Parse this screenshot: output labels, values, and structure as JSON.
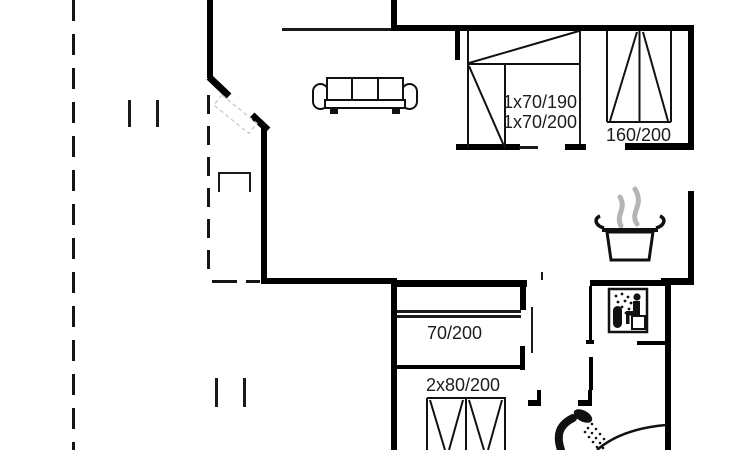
{
  "drawing": {
    "type": "floor-plan",
    "background_color": "#ffffff",
    "wall_color": "#000000",
    "text_color": "#1c1c1c",
    "steam_color": "#b5b5b5",
    "door_leaf_color": "#c9c9c9"
  },
  "rooms": {
    "bedroom_bunk": {
      "bed_label_line1": "1x70/190",
      "bed_label_line2": "1x70/200"
    },
    "bedroom_double": {
      "bed_label": "160/200"
    },
    "bedroom_single": {
      "bed_label": "70/200"
    },
    "bedroom_double2": {
      "bed_label": "2x80/200"
    }
  },
  "icons": {
    "sofa": "sofa-icon",
    "cooking_pot": "cooking-pot-icon",
    "steam": "steam-icon",
    "sauna": "sauna-icon",
    "shower": "shower-icon",
    "entrance_door": "entrance-door-leaf",
    "door_swing": "door-swing-arc"
  }
}
